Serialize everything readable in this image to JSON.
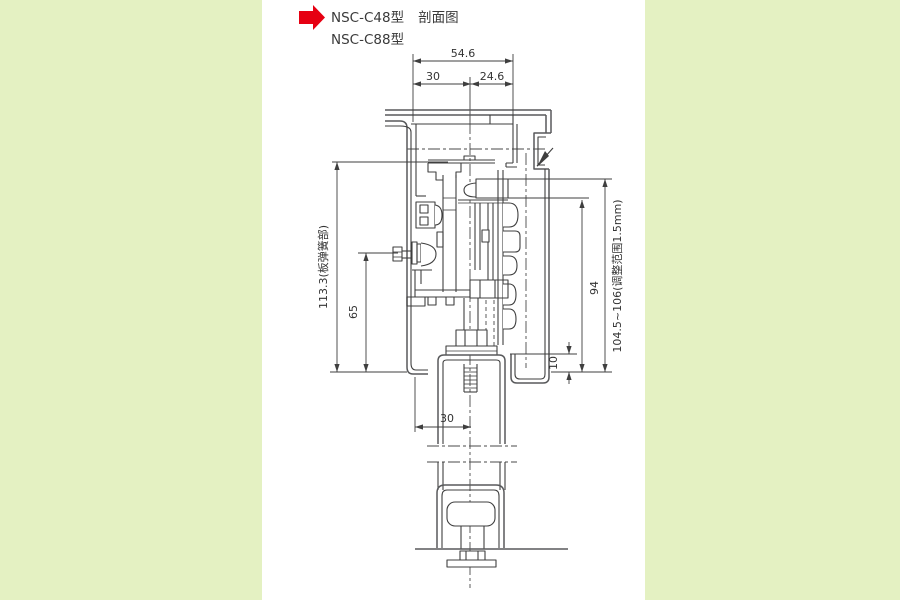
{
  "title": {
    "model_line_1": "NSC-C48型",
    "section_label": "剖面图",
    "model_line_2": "NSC-C88型"
  },
  "drawing": {
    "dimensions": {
      "top_total": "54.6",
      "top_left": "30",
      "top_right": "24.6",
      "left_overall": "113.3(板弹簧部)",
      "left_inner": "65",
      "right_overall": "104.5~106(调整范围1.5mm)",
      "right_inner": "94",
      "right_lip": "10",
      "bottom_offset": "30"
    }
  },
  "icons": {
    "pointer": "red-arrow-right-icon"
  },
  "colors": {
    "background": "#e4f1c2",
    "panel": "#ffffff",
    "line": "#3f3f3f",
    "text": "#333333",
    "accent_red": "#e60012"
  }
}
